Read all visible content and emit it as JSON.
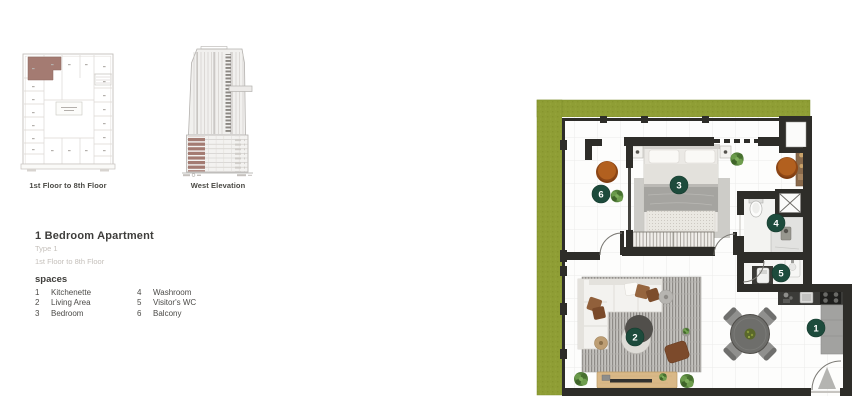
{
  "key_plan": {
    "caption": "1st Floor to 8th Floor"
  },
  "elevation": {
    "caption": "West Elevation"
  },
  "unit_info": {
    "title": "1 Bedroom Apartment",
    "subtitle": "Type 1",
    "floors": "1st Floor to 8th Floor",
    "legend_heading": "spaces",
    "legend": [
      {
        "num": "1",
        "label": "Kitchenette"
      },
      {
        "num": "2",
        "label": "Living Area"
      },
      {
        "num": "3",
        "label": "Bedroom"
      },
      {
        "num": "4",
        "label": "Washroom"
      },
      {
        "num": "5",
        "label": "Visitor's WC"
      },
      {
        "num": "6",
        "label": "Balcony"
      }
    ]
  },
  "floor_plan": {
    "badges": [
      {
        "num": "1"
      },
      {
        "num": "2"
      },
      {
        "num": "3"
      },
      {
        "num": "4"
      },
      {
        "num": "5"
      },
      {
        "num": "6"
      }
    ],
    "colors": {
      "balcony_green": "#8f9e35",
      "wall": "#2e2d29",
      "badge_green": "#1d4b3c",
      "unit_highlight": "#a47b72"
    }
  }
}
